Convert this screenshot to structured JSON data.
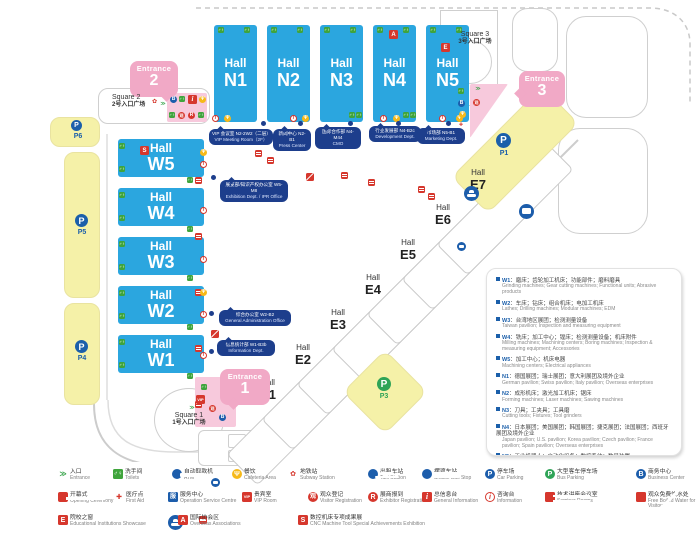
{
  "colors": {
    "hall_blue": "#2BA6DF",
    "entrance_pink": "#F1A9C6",
    "plaza_pink": "#F7C9DC",
    "parking_yellow": "#F5F1A8",
    "callout_navy": "#1D3E8C",
    "legend_red": "#D6372D",
    "toilet_green": "#3FA43C",
    "parking_blue": "#1B5FAA",
    "parking_green": "#2FA457",
    "cafeteria_yellow": "#F6B919"
  },
  "map": {
    "hall_word": "Hall",
    "north_halls": [
      {
        "id": "N1"
      },
      {
        "id": "N2"
      },
      {
        "id": "N3"
      },
      {
        "id": "N4"
      },
      {
        "id": "N5"
      }
    ],
    "west_halls": [
      {
        "id": "W5"
      },
      {
        "id": "W4"
      },
      {
        "id": "W3"
      },
      {
        "id": "W2"
      },
      {
        "id": "W1"
      }
    ],
    "east_halls": [
      {
        "id": "E1"
      },
      {
        "id": "E2"
      },
      {
        "id": "E3"
      },
      {
        "id": "E4"
      },
      {
        "id": "E5"
      },
      {
        "id": "E6"
      },
      {
        "id": "E7"
      }
    ],
    "entrances": [
      {
        "word": "Entrance",
        "number": "2"
      },
      {
        "word": "Entrance",
        "number": "1"
      },
      {
        "word": "Entrance",
        "number": "3"
      }
    ],
    "squares": [
      {
        "en": "Square 2",
        "cn": "2号入口广场"
      },
      {
        "en": "Square 1",
        "cn": "1号入口广场"
      },
      {
        "en": "Square 3",
        "cn": "3号入口广场"
      }
    ],
    "parking_lots": [
      "P6",
      "P5",
      "P4",
      "P1",
      "P3"
    ],
    "callouts": [
      {
        "cn": "VIP 会议室 N2-2W2（二层）",
        "en": "VIP Meeting Room（2F）"
      },
      {
        "cn": "新闻中心 N2-B1",
        "en": "Press Center"
      },
      {
        "cn": "国际合作部 N4-M44",
        "en": "CMO"
      },
      {
        "cn": "行业发展部 N4-B2c",
        "en": "Development Dept."
      },
      {
        "cn": "市场部 N5-B1",
        "en": "Marketing Dept."
      },
      {
        "cn": "展览部/知识产权办公室 W5-M8",
        "en": "Exhibition Dept. / IPR Office"
      },
      {
        "cn": "综合办公室 W2-B2",
        "en": "General Administration Office"
      },
      {
        "cn": "信息统计部 W1-B3b",
        "en": "Information Dept."
      }
    ]
  },
  "info_panel": {
    "items": [
      {
        "code": "W1",
        "cn": "磨床；齿轮加工机床；功能部件；磨料磨具",
        "en": "Grinding machines; Gear cutting machines; Functional units; Abrasive products"
      },
      {
        "code": "W2",
        "cn": "车床；钻床；组合机床；电加工机床",
        "en": "Lathes; Drilling machines; Modular machines; EDM"
      },
      {
        "code": "W3",
        "cn": "台湾地区展团；检测测量设备",
        "en": "Taiwan pavilion; Inspection and measuring equipment"
      },
      {
        "code": "W4",
        "cn": "铣床；加工中心；镗床；检测测量设备；机床附件",
        "en": "Milling machines; Machining centers; Boring machines; Inspection & measuring equipment; Accessories"
      },
      {
        "code": "W5",
        "cn": "加工中心；机床电器",
        "en": "Machining centers; Electrical appliances"
      },
      {
        "code": "N1",
        "cn": "德国展团；瑞士展团；意大利展团及境外企业",
        "en": "German pavilion; Swiss pavilion; Italy pavilion; Overseas enterprises"
      },
      {
        "code": "N2",
        "cn": "成形机床；激光加工机床；锯床",
        "en": "Forming machines; Laser machines; Sawing machines"
      },
      {
        "code": "N3",
        "cn": "刀具；工夹具；工具磨",
        "en": "Cutting tools; Fixtures; Tool grinders"
      },
      {
        "code": "N4",
        "cn": "日本展团；美国展团；韩国展团；捷克展团；法国展团；西班牙展团及境外企业",
        "en": "Japan pavilion; U.S. pavilion; Korea pavilion; Czech pavilion; France pavilion; Spain pavilion; Overseas enterprises"
      },
      {
        "code": "N5",
        "cn": "工业机器人；自动化设备；数控系统；数显装置",
        "en": "Industrial robots; Automation equipment; CNC systems; Digital display"
      }
    ]
  },
  "legend": {
    "items": [
      {
        "icon": "entrance",
        "cn": "入口",
        "en": "Entrance"
      },
      {
        "icon": "toilets",
        "cn": "洗手间",
        "en": "Toilets"
      },
      {
        "icon": "atm",
        "cn": "自动取款机",
        "en": "ATM"
      },
      {
        "icon": "cafeteria",
        "cn": "餐饮",
        "en": "Cafeteria Area"
      },
      {
        "icon": "subway",
        "cn": "地铁站",
        "en": "Subway Station"
      },
      {
        "icon": "taxi",
        "cn": "出租车站",
        "en": "Taxi Station"
      },
      {
        "icon": "shuttle",
        "cn": "摆渡车站",
        "en": "Shuttle Bus Stop"
      },
      {
        "icon": "carpark",
        "cn": "停车场",
        "en": "Car Parking"
      },
      {
        "icon": "buspark",
        "cn": "大型客车停车场",
        "en": "Bus Parking"
      },
      {
        "icon": "bizcenter",
        "cn": "商务中心",
        "en": "Business Center"
      },
      {
        "icon": "opening",
        "cn": "开幕式",
        "en": "Opening Ceremony"
      },
      {
        "icon": "firstaid",
        "cn": "医疗点",
        "en": "First Aid"
      },
      {
        "icon": "service",
        "cn": "服务中心",
        "en": "Operation Service Centre"
      },
      {
        "icon": "vip",
        "cn": "贵宾室",
        "en": "VIP Room"
      },
      {
        "icon": "visitor",
        "cn": "观众登记",
        "en": "Visitor Registration"
      },
      {
        "icon": "exhibitor",
        "cn": "展商报到",
        "en": "Exhibitor Registration"
      },
      {
        "icon": "geninfo",
        "cn": "总信息台",
        "en": "General Information"
      },
      {
        "icon": "info",
        "cn": "咨询台",
        "en": "Information"
      },
      {
        "icon": "seminar",
        "cn": "技术讲座会议室",
        "en": "Seminar Rooms"
      },
      {
        "icon": "water",
        "cn": "观众免费饮水处",
        "en": "Free Boiled Water for Visitors"
      },
      {
        "icon": "edu",
        "cn": "院校之窗",
        "en": "Educational Institutions Showcase"
      },
      {
        "icon": "assoc",
        "cn": "国际协会区",
        "en": "Overseas Associations"
      },
      {
        "icon": "cnc",
        "cn": "数控机床专项成果展",
        "en": "CNC Machine Tool Special Achievements Exhibition"
      }
    ]
  },
  "icon_types": {
    "entrance": {
      "glyph": "≫"
    },
    "toilets": {
      "glyph": "♂♀"
    },
    "atm": {
      "glyph": ""
    },
    "cafeteria": {
      "glyph": "Ψ"
    },
    "subway": {
      "glyph": "✿"
    },
    "taxi": {
      "glyph": ""
    },
    "shuttle": {
      "glyph": ""
    },
    "bus": {
      "glyph": ""
    },
    "carpark": {
      "glyph": "P"
    },
    "buspark": {
      "glyph": "P"
    },
    "bizcenter": {
      "glyph": "B"
    },
    "opening": {
      "glyph": ""
    },
    "firstaid": {
      "glyph": "✚"
    },
    "service": {
      "glyph": "服"
    },
    "vip": {
      "glyph": "VIP"
    },
    "visitor": {
      "glyph": "观"
    },
    "exhibitor": {
      "glyph": "R"
    },
    "geninfo": {
      "glyph": "i"
    },
    "info": {
      "glyph": "i"
    },
    "seminar": {
      "glyph": ""
    },
    "water": {
      "glyph": ""
    },
    "edu": {
      "glyph": "E"
    },
    "assoc": {
      "glyph": "A"
    },
    "cnc": {
      "glyph": "S"
    }
  }
}
